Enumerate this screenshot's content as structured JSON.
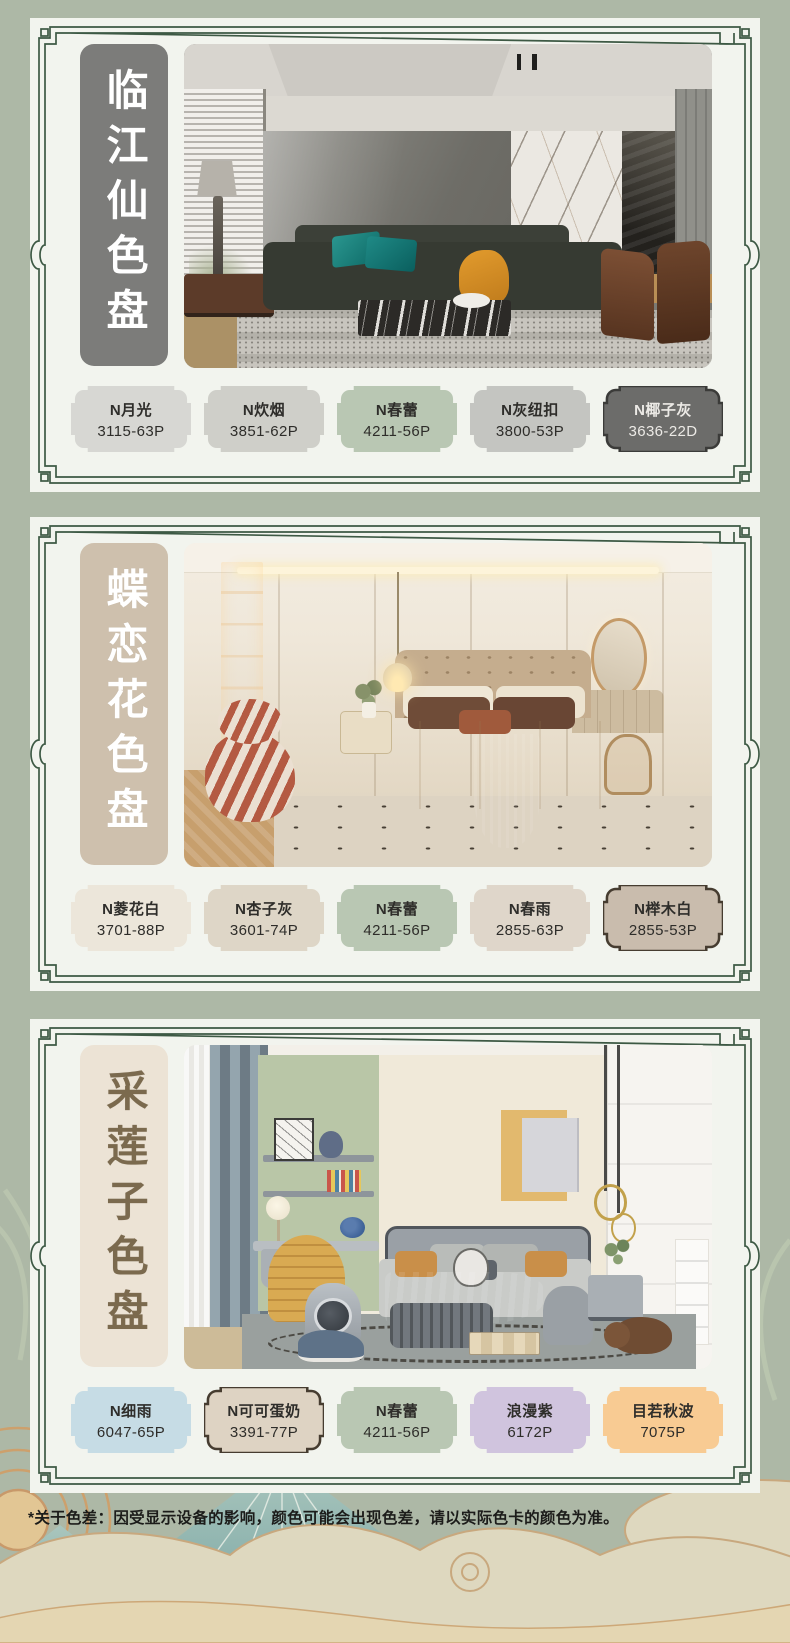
{
  "theme": {
    "page_bg": "#adb8a6",
    "card_bg": "#f2f4ee",
    "frame_green": "#3d5944",
    "footnote_color": "#1c1c1a",
    "cloud_cream": "#ded8bf",
    "cloud_outline": "#c8a87e",
    "mountain_teal": "#7fa8a4"
  },
  "footnote": "*关于色差：因受显示设备的影响，颜色可能会出现色差，请以实际色卡的颜色为准。",
  "cards": [
    {
      "title": "临江仙色盘",
      "title_bg": "#7c7c7a",
      "title_color": "#ffffff",
      "swatches": [
        {
          "name": "N月光",
          "code": "3115-63P",
          "bg": "#d7d7d3",
          "text": "#2e2d2a"
        },
        {
          "name": "N炊烟",
          "code": "3851-62P",
          "bg": "#cfcfc9",
          "text": "#2e2d2a"
        },
        {
          "name": "N春蕾",
          "code": "4211-56P",
          "bg": "#b9c7b3",
          "text": "#2e2d2a"
        },
        {
          "name": "N灰纽扣",
          "code": "3800-53P",
          "bg": "#c4c5c1",
          "text": "#2e2d2a"
        },
        {
          "name": "N椰子灰",
          "code": "3636-22D",
          "bg": "#6c6c6a",
          "text": "#eceae6",
          "border": "#3b3b39"
        }
      ]
    },
    {
      "title": "蝶恋花色盘",
      "title_bg": "#cec0ad",
      "title_color": "#ffffff",
      "swatches": [
        {
          "name": "N菱花白",
          "code": "3701-88P",
          "bg": "#ece6da",
          "text": "#2e2d2a"
        },
        {
          "name": "N杏子灰",
          "code": "3601-74P",
          "bg": "#ded6c7",
          "text": "#2e2d2a"
        },
        {
          "name": "N春蕾",
          "code": "4211-56P",
          "bg": "#b9c7b3",
          "text": "#2e2d2a"
        },
        {
          "name": "N春雨",
          "code": "2855-63P",
          "bg": "#dfd6ca",
          "text": "#2e2d2a"
        },
        {
          "name": "N榉木白",
          "code": "2855-53P",
          "bg": "#c9bcad",
          "text": "#2e2d2a",
          "border": "#463c30"
        }
      ]
    },
    {
      "title": "采莲子色盘",
      "title_bg": "#ece3d5",
      "title_color": "#7b6a4e",
      "swatches": [
        {
          "name": "N细雨",
          "code": "6047-65P",
          "bg": "#c6dce5",
          "text": "#2e2d2a"
        },
        {
          "name": "N可可蛋奶",
          "code": "3391-77P",
          "bg": "#ded3c3",
          "text": "#2e2d2a",
          "border": "#463c30"
        },
        {
          "name": "N春蕾",
          "code": "4211-56P",
          "bg": "#b9c7b3",
          "text": "#2e2d2a"
        },
        {
          "name": "浪漫紫",
          "code": "6172P",
          "bg": "#d0c4de",
          "text": "#2e2d2a"
        },
        {
          "name": "目若秋波",
          "code": "7075P",
          "bg": "#f8cb93",
          "text": "#2e2d2a"
        }
      ]
    }
  ]
}
